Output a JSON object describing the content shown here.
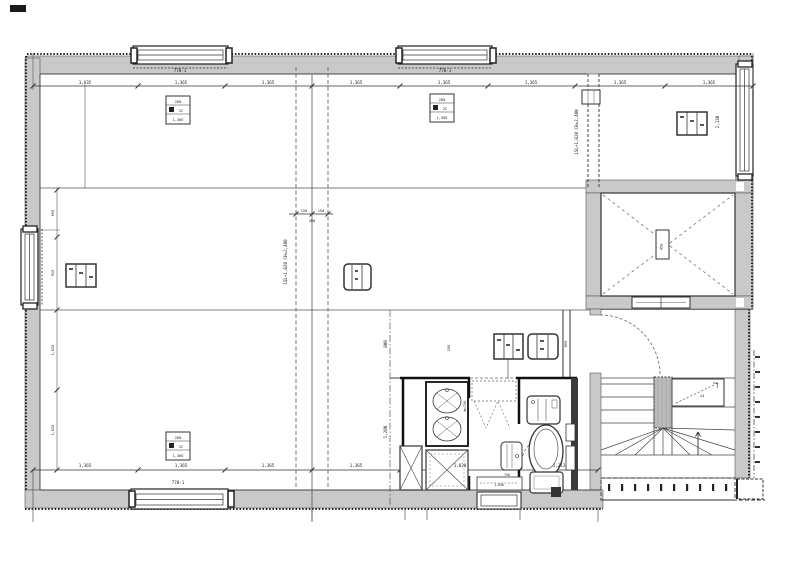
{
  "meta": {
    "drawing_type": "architectural floor plan (scanned CAD)"
  },
  "colors": {
    "wall_fill": "#c9c9c9",
    "line": "#333333",
    "dark": "#111111",
    "dash_gray": "#777777",
    "paper": "#ffffff"
  },
  "dims": {
    "top": {
      "segments": [
        "1,635",
        "1,365",
        "1,365",
        "1,365",
        "1,365",
        "1,365",
        "1,365",
        "1,365"
      ]
    },
    "top_window_1": "770-1",
    "top_window_2": "770-1",
    "bottom": {
      "segments": [
        "1,365",
        "1,365",
        "1,365",
        "1,365",
        "1,820",
        "1,213"
      ]
    },
    "bottom_window": "770-1",
    "left": {
      "segments": [
        "600",
        "910",
        "1,820",
        "1,820"
      ]
    },
    "center": {
      "a": "150",
      "b": "150",
      "c": "300"
    },
    "right_window": "2,130",
    "bath_a": "800",
    "bath_b": "1,200",
    "toilet_wall": "800",
    "corridor": "W=750",
    "tag_note": "250"
  },
  "notes": {
    "center_line": "1SL+1,820 CH=2,400",
    "partition_line": "1SL+1,820 CH=2,400"
  },
  "labels": {
    "threshold": "1,650",
    "washbasin": "750",
    "stair_up": "14",
    "elevator": "450"
  },
  "tags": {
    "ac_rows": [
      "200",
      "2C",
      "1,365"
    ]
  }
}
